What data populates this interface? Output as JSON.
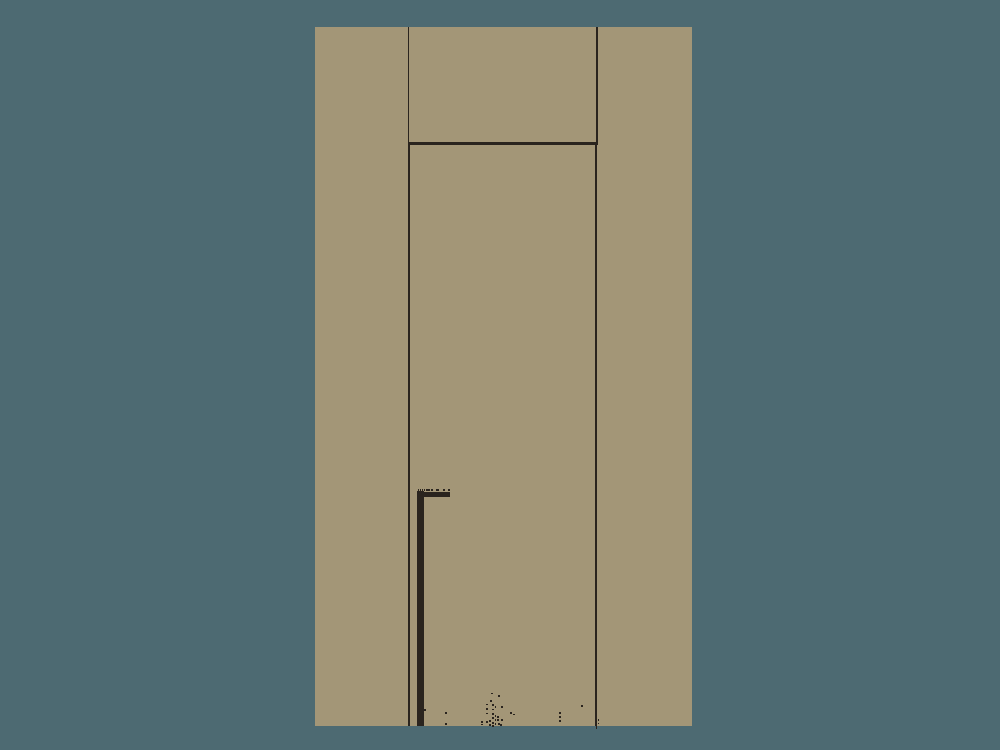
{
  "canvas": {
    "width": 1000,
    "height": 750,
    "background_color": "#4d6a72"
  },
  "colors": {
    "background": "#4d6a72",
    "wall": "#a39677",
    "line": "#2a241e"
  },
  "rects": [
    {
      "name": "wall-panel",
      "x": 315,
      "y": 27,
      "w": 377,
      "h": 699,
      "color": "#a39677"
    },
    {
      "name": "transom-left-frame-line",
      "x": 407.8,
      "y": 27,
      "w": 1.5,
      "h": 115.5
    },
    {
      "name": "transom-right-frame-line",
      "x": 596.4,
      "y": 27,
      "w": 1.5,
      "h": 115.5
    },
    {
      "name": "door-header-line",
      "x": 407.8,
      "y": 142.2,
      "w": 190.4,
      "h": 2.5
    },
    {
      "name": "door-leaf-left-edge",
      "x": 407.8,
      "y": 144.7,
      "w": 2.4,
      "h": 581.3
    },
    {
      "name": "door-leaf-right-edge",
      "x": 594.8,
      "y": 144.7,
      "w": 2.5,
      "h": 581.3
    },
    {
      "name": "door-right-edge-tip",
      "x": 595.6,
      "y": 726,
      "w": 1.4,
      "h": 3.2
    },
    {
      "name": "pipe-vertical",
      "x": 417.4,
      "y": 491,
      "w": 6.3,
      "h": 235
    },
    {
      "name": "pipe-arm",
      "x": 417.4,
      "y": 491.5,
      "w": 32.6,
      "h": 5.6
    },
    {
      "name": "pipe-serration-tick",
      "x": 417.6,
      "y": 488.6,
      "w": 1.2,
      "h": 2.7
    },
    {
      "name": "pipe-serration-tick",
      "x": 419.6,
      "y": 488.6,
      "w": 1.2,
      "h": 2.7
    },
    {
      "name": "pipe-serration-tick",
      "x": 421.6,
      "y": 488.6,
      "w": 1.2,
      "h": 2.7
    },
    {
      "name": "pipe-serration-tick",
      "x": 423.6,
      "y": 488.6,
      "w": 1.2,
      "h": 2.7
    },
    {
      "name": "pipe-serration-tick",
      "x": 425.5,
      "y": 488.6,
      "w": 1.2,
      "h": 2.7
    },
    {
      "name": "pipe-serration-tick",
      "x": 427.4,
      "y": 488.6,
      "w": 1.2,
      "h": 2.7
    },
    {
      "name": "pipe-serration-tick",
      "x": 429.2,
      "y": 488.6,
      "w": 1.0,
      "h": 2.7
    },
    {
      "name": "pipe-serration-tick",
      "x": 431.3,
      "y": 488.6,
      "w": 2.0,
      "h": 2.7
    },
    {
      "name": "pipe-serration-tick",
      "x": 436.3,
      "y": 488.6,
      "w": 2.6,
      "h": 2.7
    },
    {
      "name": "pipe-serration-tick",
      "x": 442.8,
      "y": 488.6,
      "w": 2.2,
      "h": 2.7
    },
    {
      "name": "pipe-serration-tick",
      "x": 447.8,
      "y": 488.6,
      "w": 2.2,
      "h": 2.7
    },
    {
      "name": "pipe-notch",
      "x": 424.0,
      "y": 709,
      "w": 1.5,
      "h": 1.5
    },
    {
      "name": "right-edge-tick",
      "x": 594.9,
      "y": 664.2,
      "w": 1.2,
      "h": 2.0
    },
    {
      "name": "right-edge-tick",
      "x": 594.9,
      "y": 668.4,
      "w": 1.2,
      "h": 1.5
    },
    {
      "name": "right-edge-tick",
      "x": 594.9,
      "y": 711.7,
      "w": 1.2,
      "h": 2.0
    },
    {
      "name": "right-edge-tick",
      "x": 594.9,
      "y": 715.8,
      "w": 1.2,
      "h": 1.4
    },
    {
      "name": "right-edge-tick",
      "x": 594.9,
      "y": 719.3,
      "w": 1.2,
      "h": 1.7
    },
    {
      "name": "right-edge-tick",
      "x": 594.9,
      "y": 722.8,
      "w": 1.2,
      "h": 1.4
    },
    {
      "name": "right-edge-tick",
      "x": 598.2,
      "y": 719.0,
      "w": 1.2,
      "h": 2.0
    },
    {
      "name": "right-edge-tick",
      "x": 598.2,
      "y": 722.7,
      "w": 1.2,
      "h": 1.4
    }
  ],
  "speckles": [
    [
      491,
      692.5
    ],
    [
      498,
      695
    ],
    [
      490,
      700
    ],
    [
      486,
      703.5
    ],
    [
      492,
      704
    ],
    [
      494.5,
      706
    ],
    [
      501,
      706
    ],
    [
      486,
      708
    ],
    [
      492,
      708.5
    ],
    [
      486,
      712.5
    ],
    [
      492,
      713
    ],
    [
      494.5,
      715
    ],
    [
      497,
      716
    ],
    [
      510,
      712
    ],
    [
      513,
      713.5
    ],
    [
      492,
      717
    ],
    [
      494.5,
      719
    ],
    [
      497,
      719
    ],
    [
      501,
      719
    ],
    [
      489,
      720
    ],
    [
      481,
      721
    ],
    [
      486,
      721
    ],
    [
      492,
      722
    ],
    [
      481,
      723.5
    ],
    [
      494.5,
      723
    ],
    [
      498,
      723
    ],
    [
      489,
      724
    ],
    [
      492,
      725
    ],
    [
      500,
      724
    ],
    [
      445,
      712
    ],
    [
      445,
      723
    ],
    [
      559,
      712
    ],
    [
      559,
      716
    ],
    [
      559,
      720
    ],
    [
      581,
      705
    ]
  ],
  "speckle_size": 1.6
}
